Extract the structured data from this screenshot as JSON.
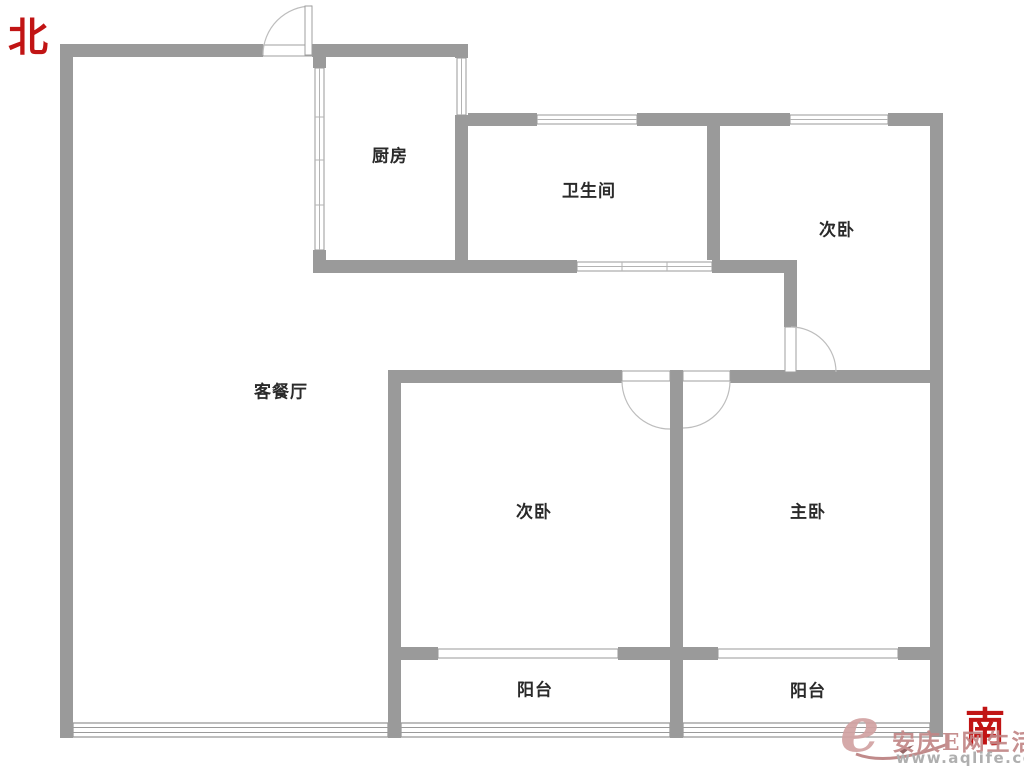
{
  "compass": {
    "north_label": "北",
    "south_label": "南"
  },
  "rooms": [
    {
      "name": "kitchen",
      "label": "厨房"
    },
    {
      "name": "bathroom",
      "label": "卫生间"
    },
    {
      "name": "second-bedroom-north",
      "label": "次卧"
    },
    {
      "name": "living-dining-room",
      "label": "客餐厅"
    },
    {
      "name": "second-bedroom-south",
      "label": "次卧"
    },
    {
      "name": "master-bedroom",
      "label": "主卧"
    },
    {
      "name": "balcony-left",
      "label": "阳台"
    },
    {
      "name": "balcony-right",
      "label": "阳台"
    }
  ],
  "watermark": {
    "logo_letter": "e",
    "site_name": "安庆E网生活",
    "url": "www.aqlife.com"
  },
  "colors": {
    "wall": "#9a9a9a",
    "room_label": "#2a2a2a",
    "compass_red": "#c11414",
    "watermark_rose": "#c28686",
    "watermark_gray": "#a9a9a9"
  }
}
